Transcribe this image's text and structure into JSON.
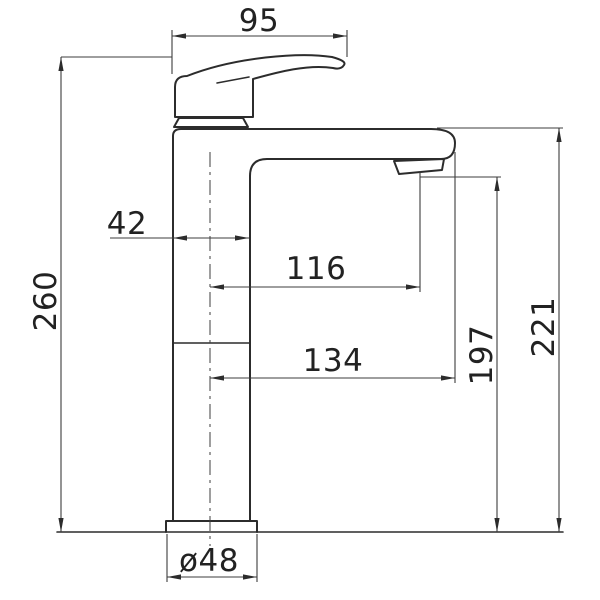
{
  "drawing": {
    "type": "technical-dimension-drawing",
    "subject": "tall basin mixer tap, side elevation",
    "units": "mm",
    "colors": {
      "background": "#ffffff",
      "object_line": "#2c2c2c",
      "dimension_line": "#3d3d3d",
      "text": "#222222"
    },
    "dimensions": {
      "handle_length": "95",
      "body_width": "42",
      "overall_height": "260",
      "reach_to_outlet": "116",
      "reach_to_spout_end": "134",
      "outlet_height": "197",
      "body_top_height": "221",
      "base_diameter": "ø48"
    }
  }
}
